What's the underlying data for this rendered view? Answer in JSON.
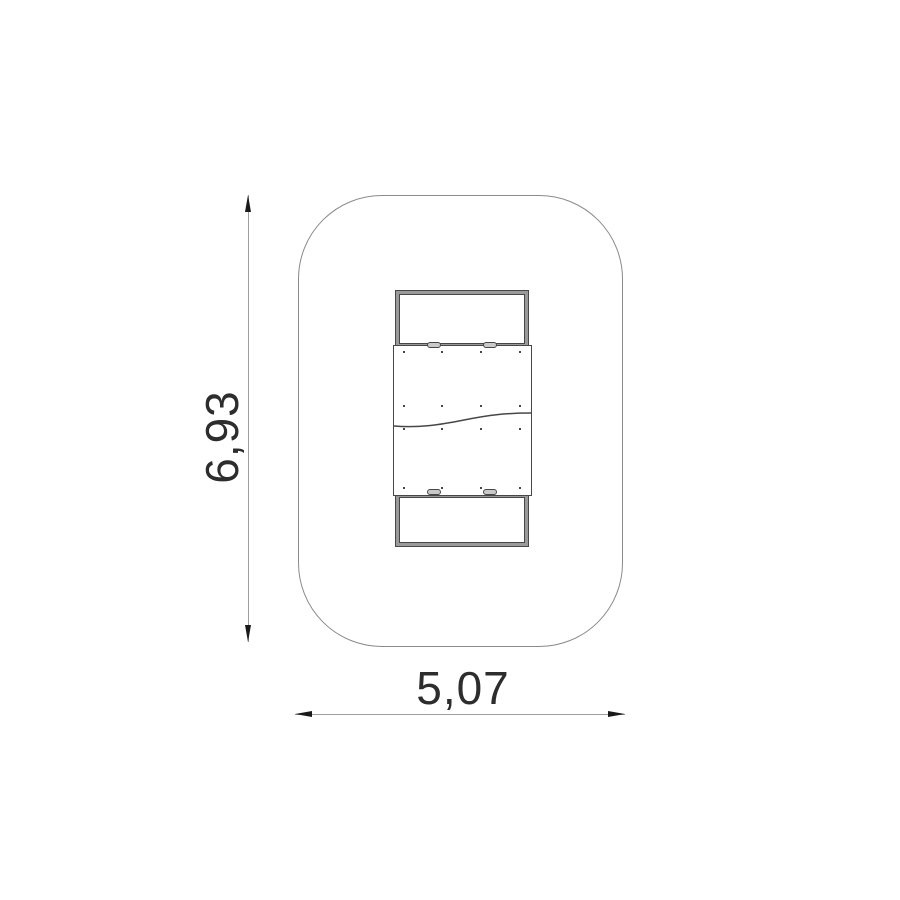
{
  "drawing": {
    "height_label": "6,93",
    "width_label": "5,07",
    "colors": {
      "background": "#ffffff",
      "zone_outline": "#8a8a8a",
      "equipment_line": "#474747",
      "frame_band": "#9a9a9a",
      "slot_fill": "#c9c9c9",
      "dimension_line": "#9e9e9e",
      "arrowhead": "#1a1a1a",
      "label_text": "#2d2d2d"
    },
    "fasteners": {
      "columns_px": [
        404,
        442,
        481,
        520
      ],
      "rows_px": [
        352,
        406,
        429,
        488
      ]
    },
    "slots": {
      "xs_px": [
        427,
        483
      ],
      "row_ys_px": [
        342,
        489
      ]
    },
    "seam_path": "M 0 25 C 25 27 45 24 70 19 C 95 14 112 12 137 12"
  }
}
